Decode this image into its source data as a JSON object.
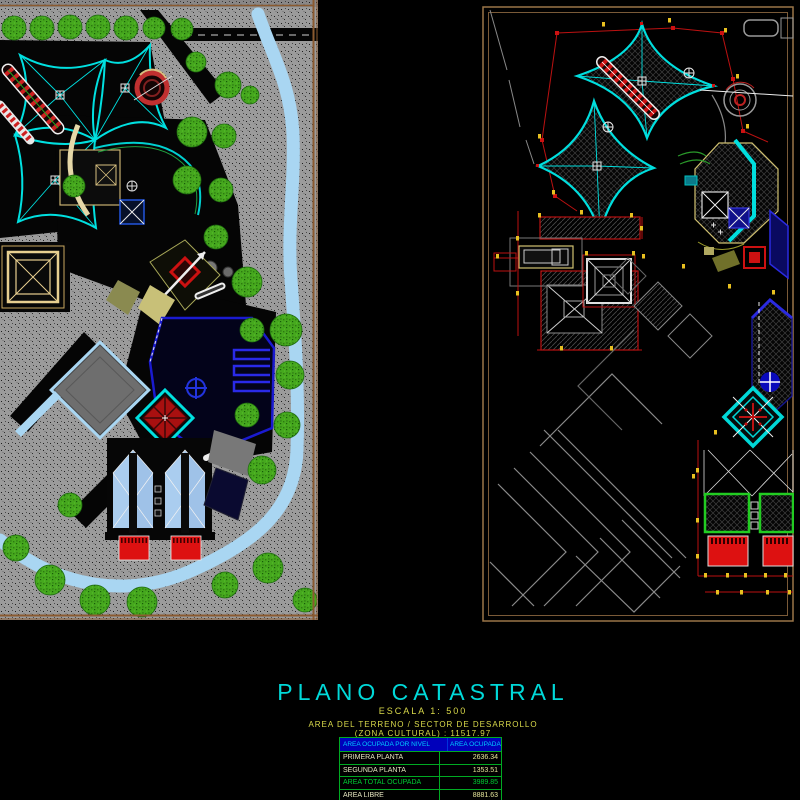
{
  "title_block": {
    "title": "PLANO CATASTRAL",
    "scale_label": "ESCALA 1: 500",
    "area_line1": "AREA  DEL  TERRENO  /  SECTOR  DE  DESARROLLO",
    "area_line2": "(ZONA  CULTURAL) :  11517.97",
    "terrain_area": "11517.97"
  },
  "area_table": {
    "header_col1": "AREA OCUPADA POR NIVEL",
    "header_col2": "AREA OCUPADA",
    "rows": [
      {
        "label": "PRIMERA PLANTA",
        "value": "2636.34"
      },
      {
        "label": "SEGUNDA PLANTA",
        "value": "1353.51"
      },
      {
        "label": "AREA TOTAL OCUPADA",
        "value": "3989.85"
      },
      {
        "label": "AREA LIBRE",
        "value": "8881.63"
      }
    ]
  },
  "colors": {
    "accent_cyan": "#00d9d9",
    "annotation_yellow": "#d9d94a",
    "boundary_red": "#bb1111",
    "frame_brown": "#9a7648",
    "water_blue": "#a9d6f2",
    "tree_green": "#46a81e",
    "table_header_bg": "#0000bb",
    "table_header_text": "#00ccff",
    "table_border_green": "#00aa22",
    "total_row_green": "#00cc33"
  }
}
